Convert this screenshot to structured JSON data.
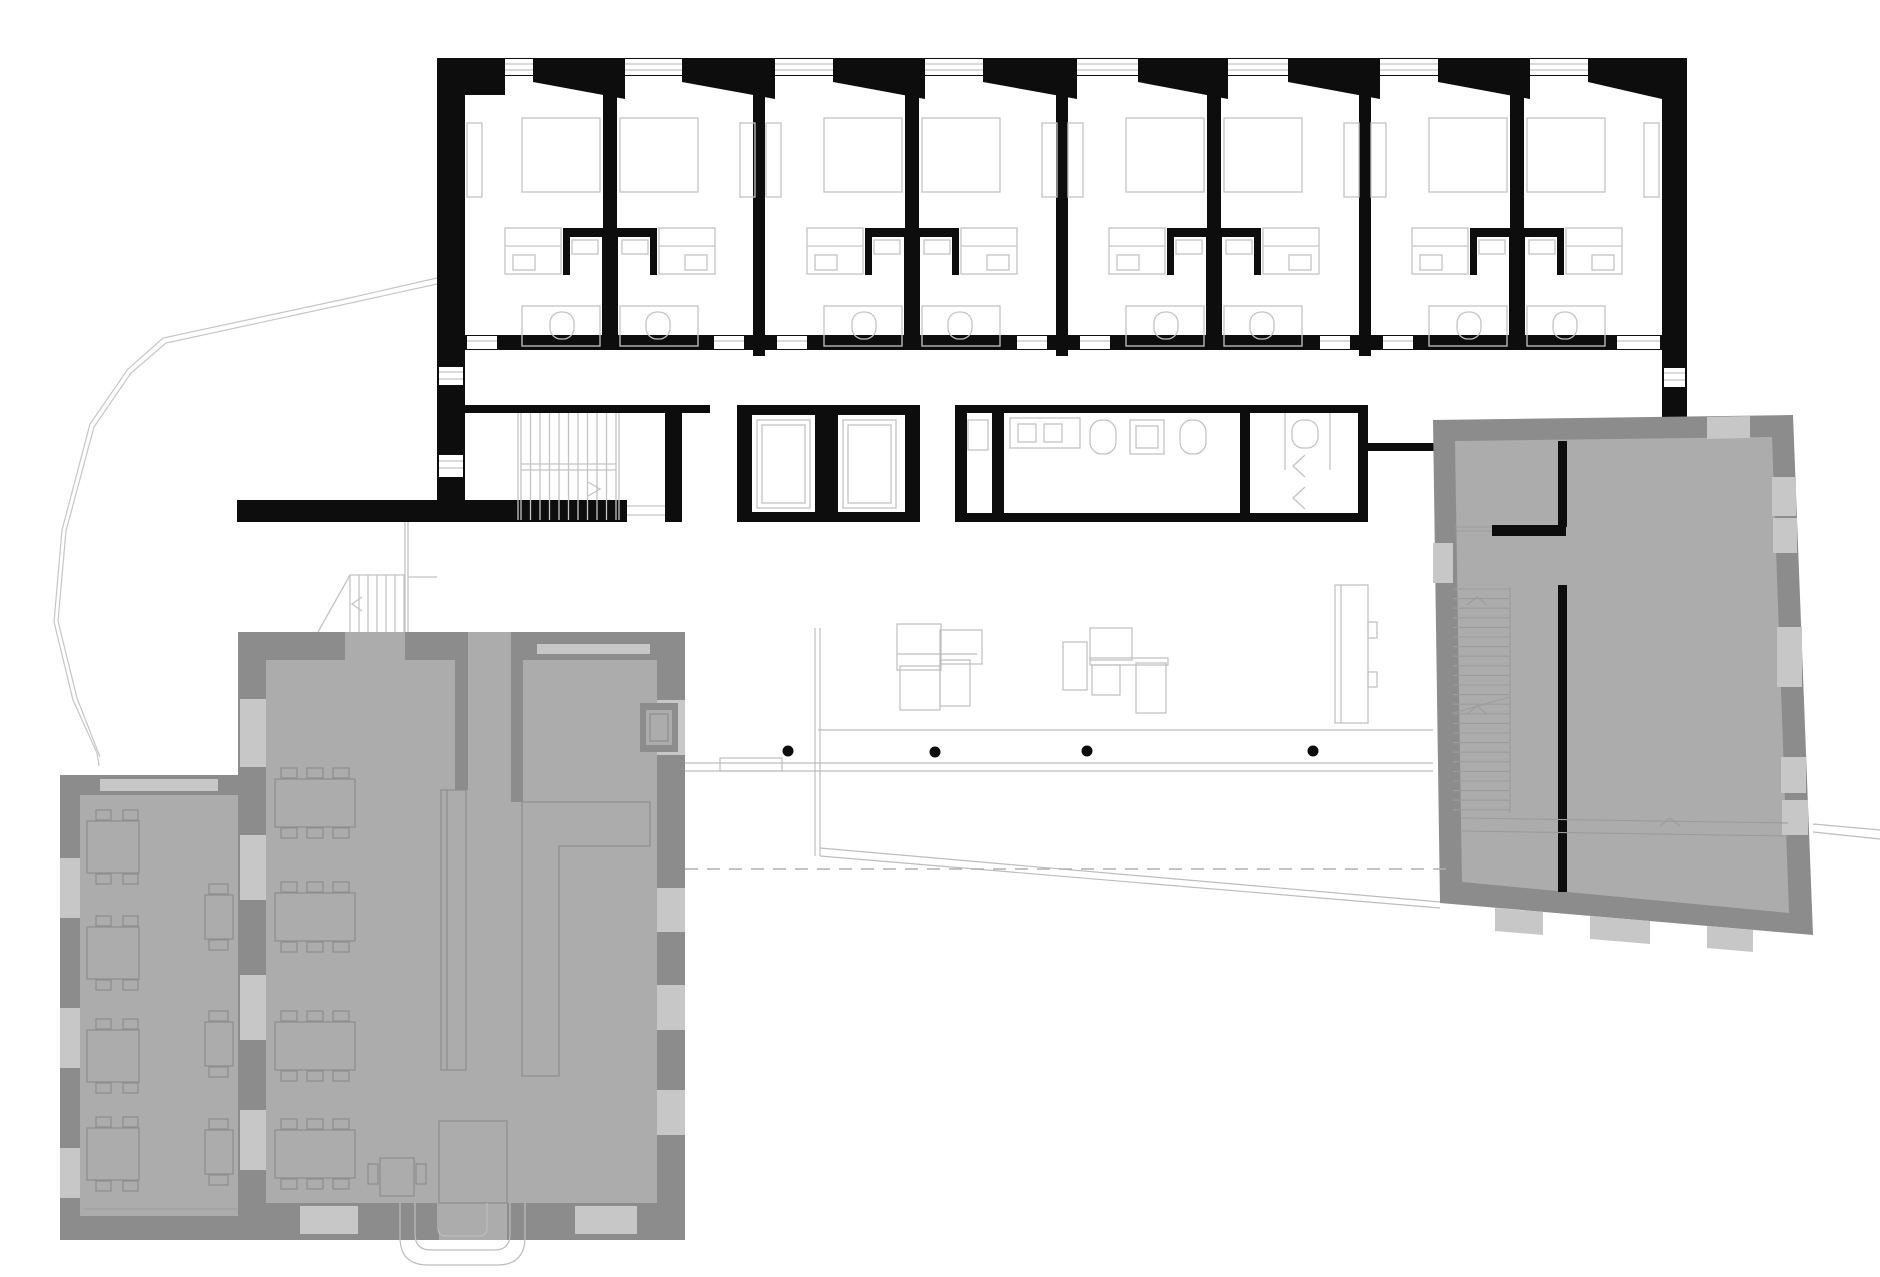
{
  "document": {
    "kind": "architectural floor plan",
    "description": "Ground/upper floor plan: new hotel wing with 8 guest rooms (black walls) above a service band with staircase, two elevators and sanitary block; two existing heritage buildings rendered in gray (restaurant hall with annex at lower left, east building with staircase at right); open lobby with columns, desks, walkway lines, ramp and dashed site line."
  },
  "colors": {
    "paper": "#ffffff",
    "wall": "#0d0d0d",
    "thin": "#c4c4c4",
    "thin2": "#bdbdbd",
    "gray_wall": "#8c8c8c",
    "gray_window": "#c7c7c7",
    "gray_floor": "#acacac",
    "gray_furniture": "#8f8f8f",
    "gray_line": "#9b9b9b",
    "dash_color": "#b0b0b0",
    "boundary": "#c6c6c6"
  },
  "plan": {
    "hotel": {
      "module_centers": [
        610,
        912,
        1214,
        1517
      ],
      "boundary_walls": [
        753,
        1056,
        1359
      ],
      "lintels": [
        [
          533,
          625
        ],
        [
          682,
          775
        ],
        [
          833,
          925
        ],
        [
          983,
          1077
        ],
        [
          1138,
          1228
        ],
        [
          1288,
          1380
        ],
        [
          1438,
          1530
        ],
        [
          1588,
          1662
        ]
      ],
      "top_windows": [
        [
          505,
          533
        ],
        [
          625,
          682
        ],
        [
          775,
          833
        ],
        [
          925,
          983
        ],
        [
          1077,
          1138
        ],
        [
          1228,
          1288
        ],
        [
          1380,
          1438
        ],
        [
          1530,
          1588
        ]
      ],
      "door_gaps": [
        [
          467,
          30
        ],
        [
          714,
          30
        ],
        [
          777,
          30
        ],
        [
          1017,
          30
        ],
        [
          1080,
          30
        ],
        [
          1320,
          30
        ],
        [
          1383,
          30
        ],
        [
          1617,
          43
        ]
      ]
    },
    "stairs": {
      "main": {
        "x1": 521,
        "x2": 616,
        "y1": 413,
        "y2": 520,
        "step": 9.5
      },
      "heritage": {
        "x1": 1453,
        "x2": 1510,
        "y1": 589,
        "y2": 813,
        "step": 9.6
      },
      "small": {
        "x1": 350,
        "x2": 405,
        "y1": 575,
        "y2": 632,
        "step": 9
      }
    },
    "lobby": {
      "columns": [
        [
          788,
          751
        ],
        [
          935,
          752
        ],
        [
          1087,
          751
        ],
        [
          1313,
          751
        ]
      ],
      "column_radius": 5.5
    },
    "restaurant": {
      "tables_4seat_y": [
        821,
        927,
        1030,
        1128
      ],
      "tables_2seat_y": [
        895,
        1022,
        1130
      ],
      "tables_6seat_y": [
        779,
        893,
        1022,
        1130
      ],
      "left_wall_windows": [
        [
          699,
          68
        ],
        [
          835,
          65
        ],
        [
          975,
          65
        ],
        [
          1110,
          60
        ]
      ],
      "right_wall_windows": [
        [
          700,
          55
        ],
        [
          888,
          44
        ],
        [
          985,
          45
        ],
        [
          1090,
          45
        ]
      ],
      "annex_left_windows": [
        [
          858,
          60
        ],
        [
          1008,
          60
        ],
        [
          1148,
          50
        ]
      ]
    }
  }
}
